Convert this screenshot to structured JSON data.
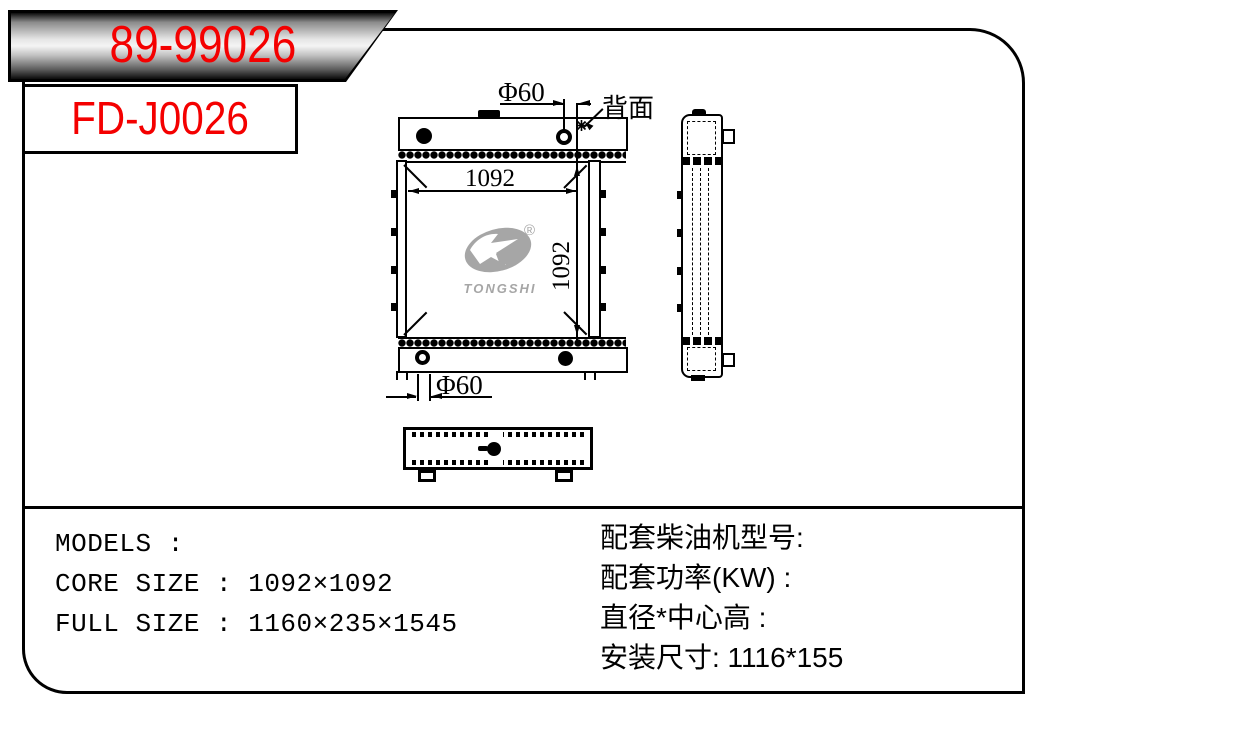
{
  "part_numbers": {
    "primary": "89-99026",
    "secondary": "FD-J0026"
  },
  "drawing": {
    "dim_core_width": "1092",
    "dim_core_height": "1092",
    "dim_hole_top": "Φ60",
    "dim_hole_bottom": "Φ60",
    "label_backside": "背面",
    "logo": {
      "brand": "TONGSHI",
      "registered": "®"
    }
  },
  "specs": {
    "left": [
      "MODELS :",
      "CORE SIZE : 1092×1092",
      "FULL SIZE : 1160×235×1545"
    ],
    "right": [
      "配套柴油机型号:",
      "配套功率(KW) :",
      "直径*中心高 :",
      "安装尺寸: 1116*155"
    ]
  },
  "colors": {
    "accent_red": "#f40000",
    "line_black": "#000000",
    "logo_gray": "#a6a6a6"
  }
}
